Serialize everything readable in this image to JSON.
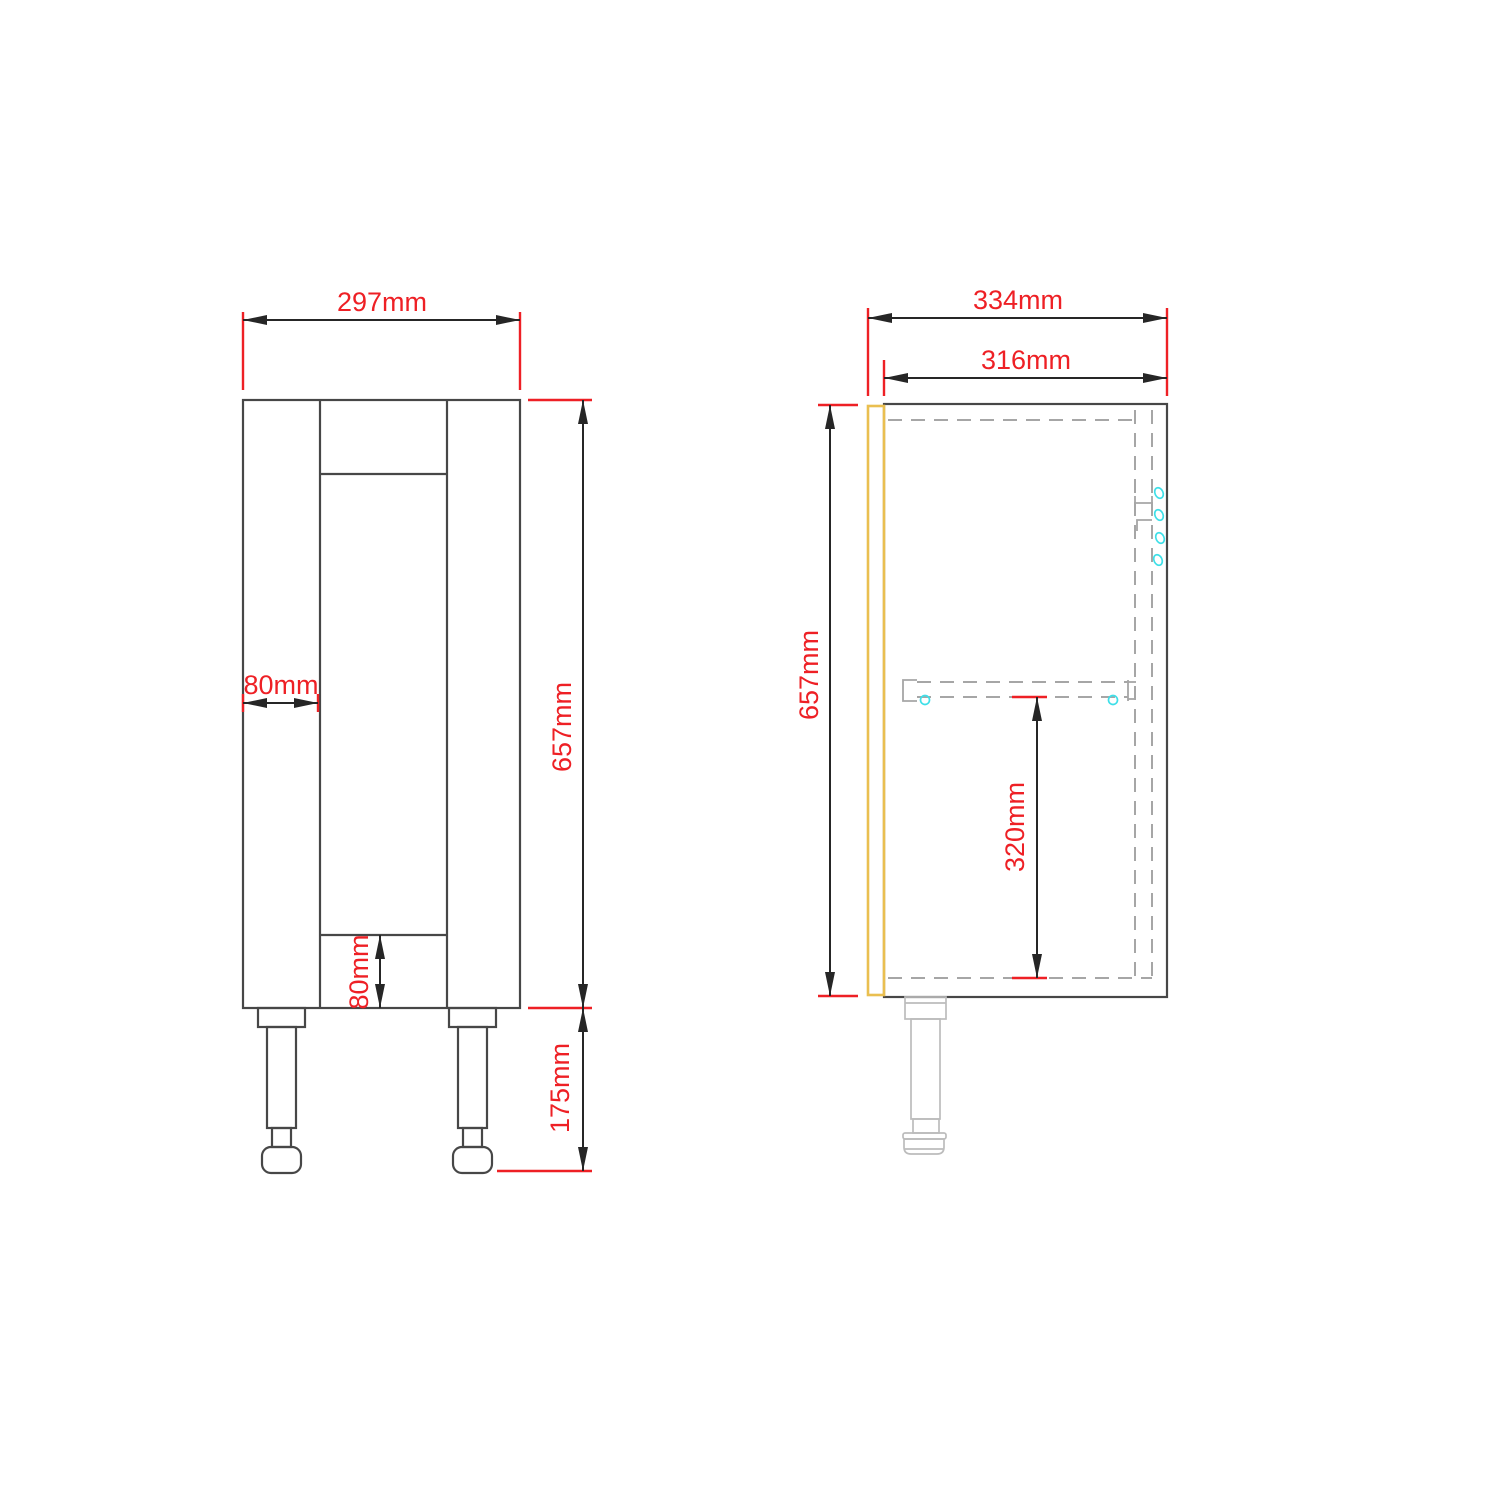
{
  "dims": {
    "front_overall_width": "297mm",
    "front_stile_width": "80mm",
    "front_bottom_rail_height": "80mm",
    "front_carcass_height": "657mm",
    "front_leg_height": "175mm",
    "side_overall_depth": "334mm",
    "side_carcass_depth": "316mm",
    "side_carcass_height": "657mm",
    "side_shelf_height": "320mm"
  },
  "colors": {
    "dimension_red": "#ee2025",
    "outline_dark": "#474747",
    "hidden_gray": "#a6a6a6",
    "door_yellow": "#eabf50",
    "hardware_cyan": "#3edfe8",
    "leg_gray": "#bcbcbc",
    "background": "#ffffff"
  }
}
